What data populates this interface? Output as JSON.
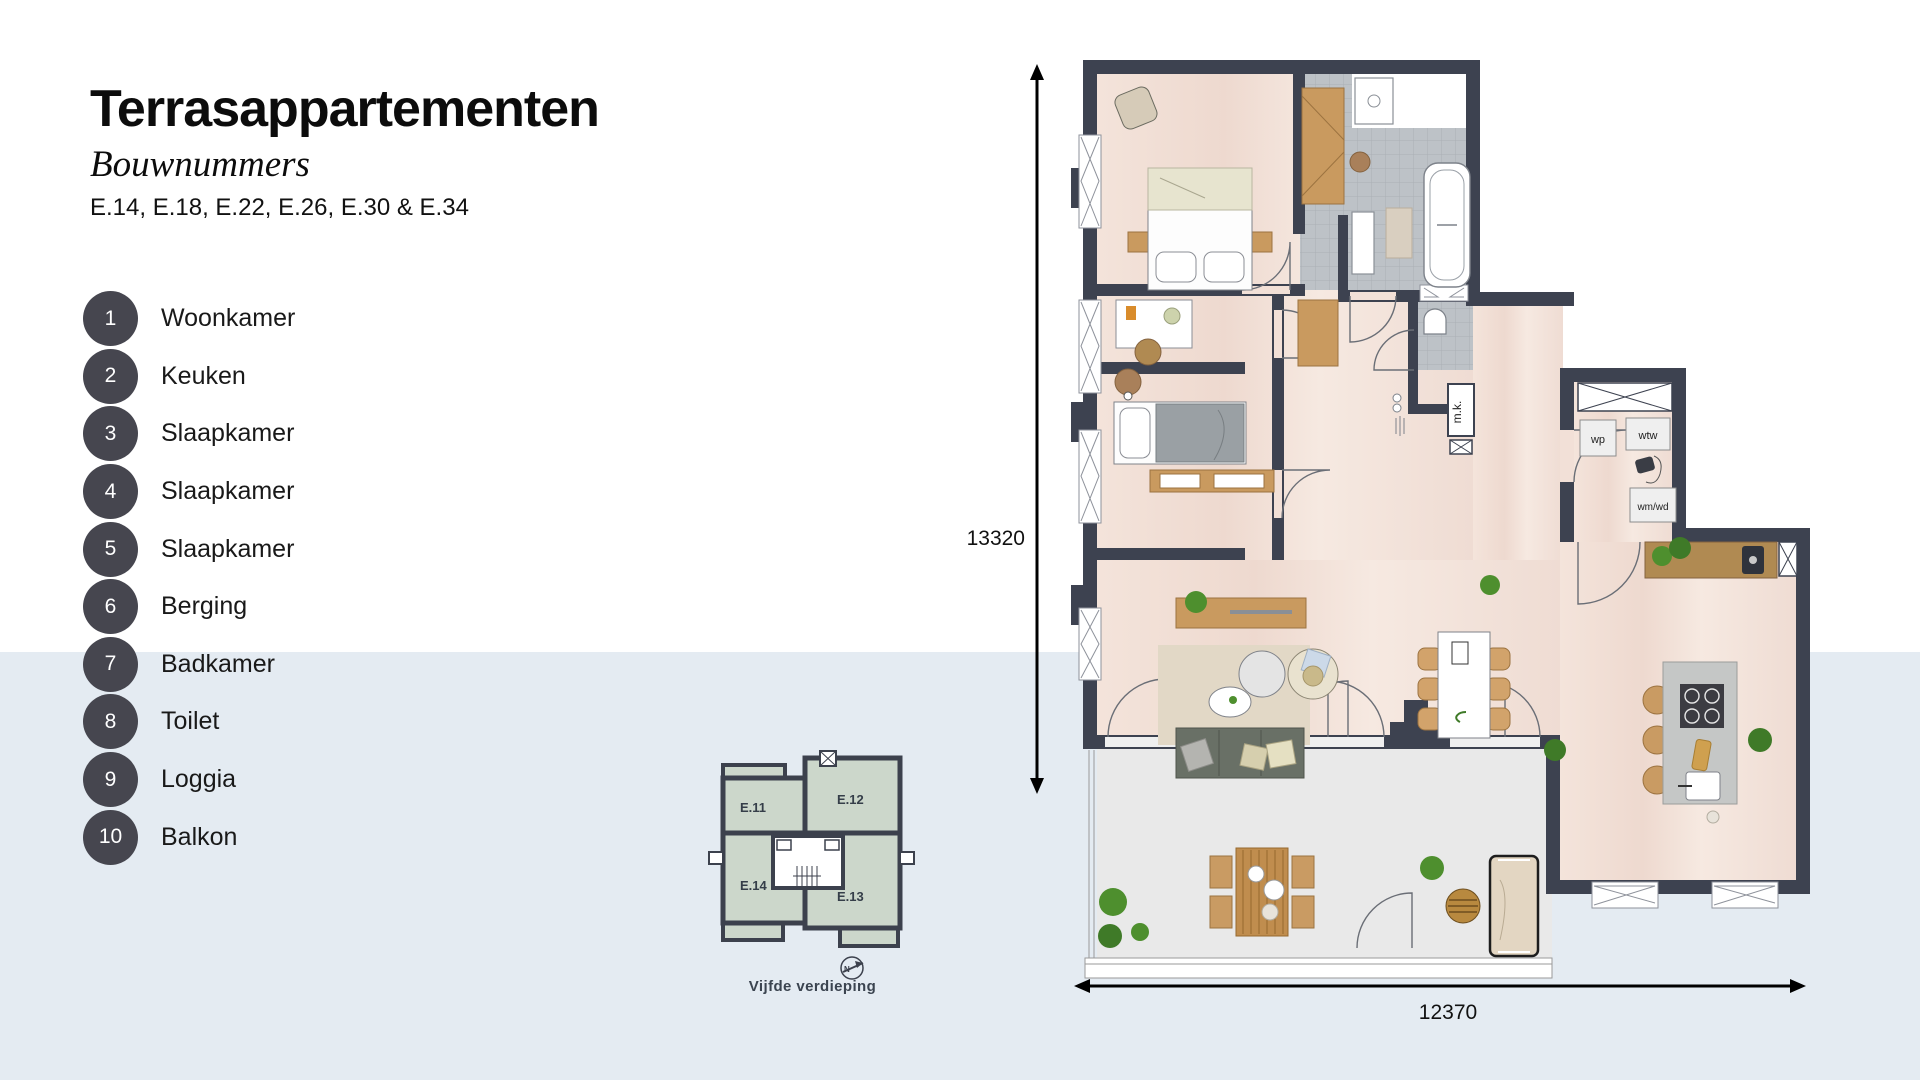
{
  "header": {
    "title": "Terrasappartementen",
    "subtitle": "Bouwnummers",
    "numbers_line": "E.14, E.18, E.22, E.26, E.30 & E.34"
  },
  "legend": {
    "items": [
      {
        "num": "1",
        "label": "Woonkamer"
      },
      {
        "num": "2",
        "label": "Keuken"
      },
      {
        "num": "3",
        "label": "Slaapkamer"
      },
      {
        "num": "4",
        "label": "Slaapkamer"
      },
      {
        "num": "5",
        "label": "Slaapkamer"
      },
      {
        "num": "6",
        "label": "Berging"
      },
      {
        "num": "7",
        "label": "Badkamer"
      },
      {
        "num": "8",
        "label": "Toilet"
      },
      {
        "num": "9",
        "label": "Loggia"
      },
      {
        "num": "10",
        "label": "Balkon"
      }
    ]
  },
  "mini_plan": {
    "units": {
      "e11": "E.11",
      "e12": "E.12",
      "e13": "E.13",
      "e14": "E.14"
    },
    "caption": "Vijfde verdieping",
    "compass": "N"
  },
  "floor_plan": {
    "labels": {
      "wp": "wp",
      "wtw": "wtw",
      "wmwd": "wm/wd",
      "mk": "m.k."
    },
    "dimensions": {
      "height_mm": "13320",
      "width_mm": "12370"
    }
  },
  "colors": {
    "wall": "#3d4250",
    "badge": "#46464f",
    "band": "#e4ebf2",
    "mini_room": "#ccd7cb",
    "floor_wood": "#f1ded5",
    "tile": "#bdc2c7",
    "terrace": "#e9e9e9"
  }
}
